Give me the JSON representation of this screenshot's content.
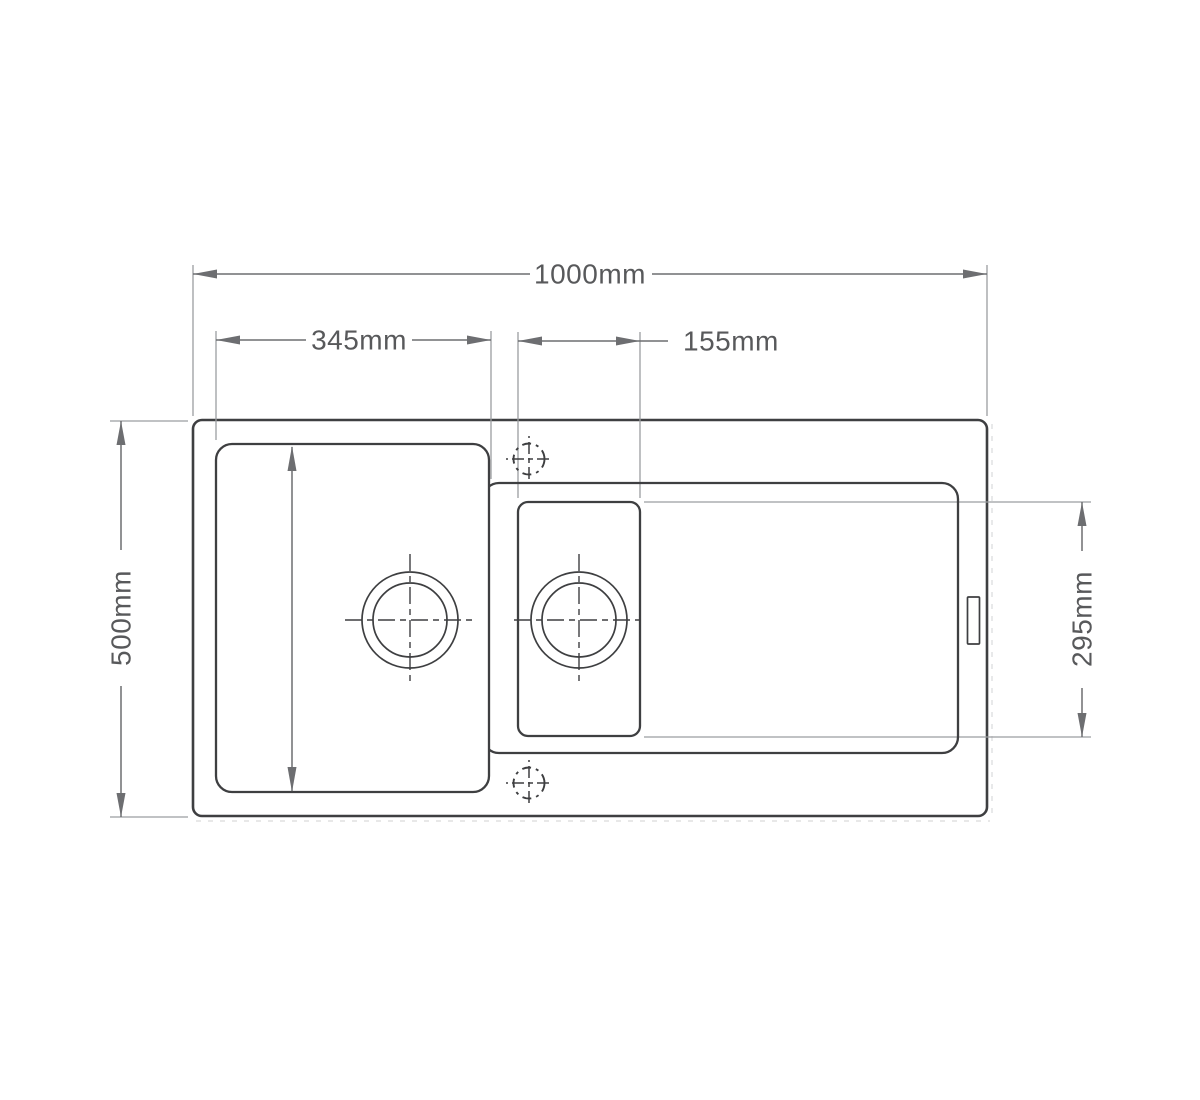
{
  "drawing": {
    "view": "sink-plan-technical-drawing"
  },
  "dimension_labels": {
    "overall_width": "1000mm",
    "main_bowl_width": "345mm",
    "half_bowl_width": "155mm",
    "overall_depth": "500mm",
    "half_bowl_depth": "295mm"
  },
  "colors": {
    "object": "#3e3f41",
    "dim": "#6d6e71",
    "ext": "#9b9da0",
    "text": "#58595b",
    "ghost": "#d9dadb",
    "background": "#ffffff"
  }
}
